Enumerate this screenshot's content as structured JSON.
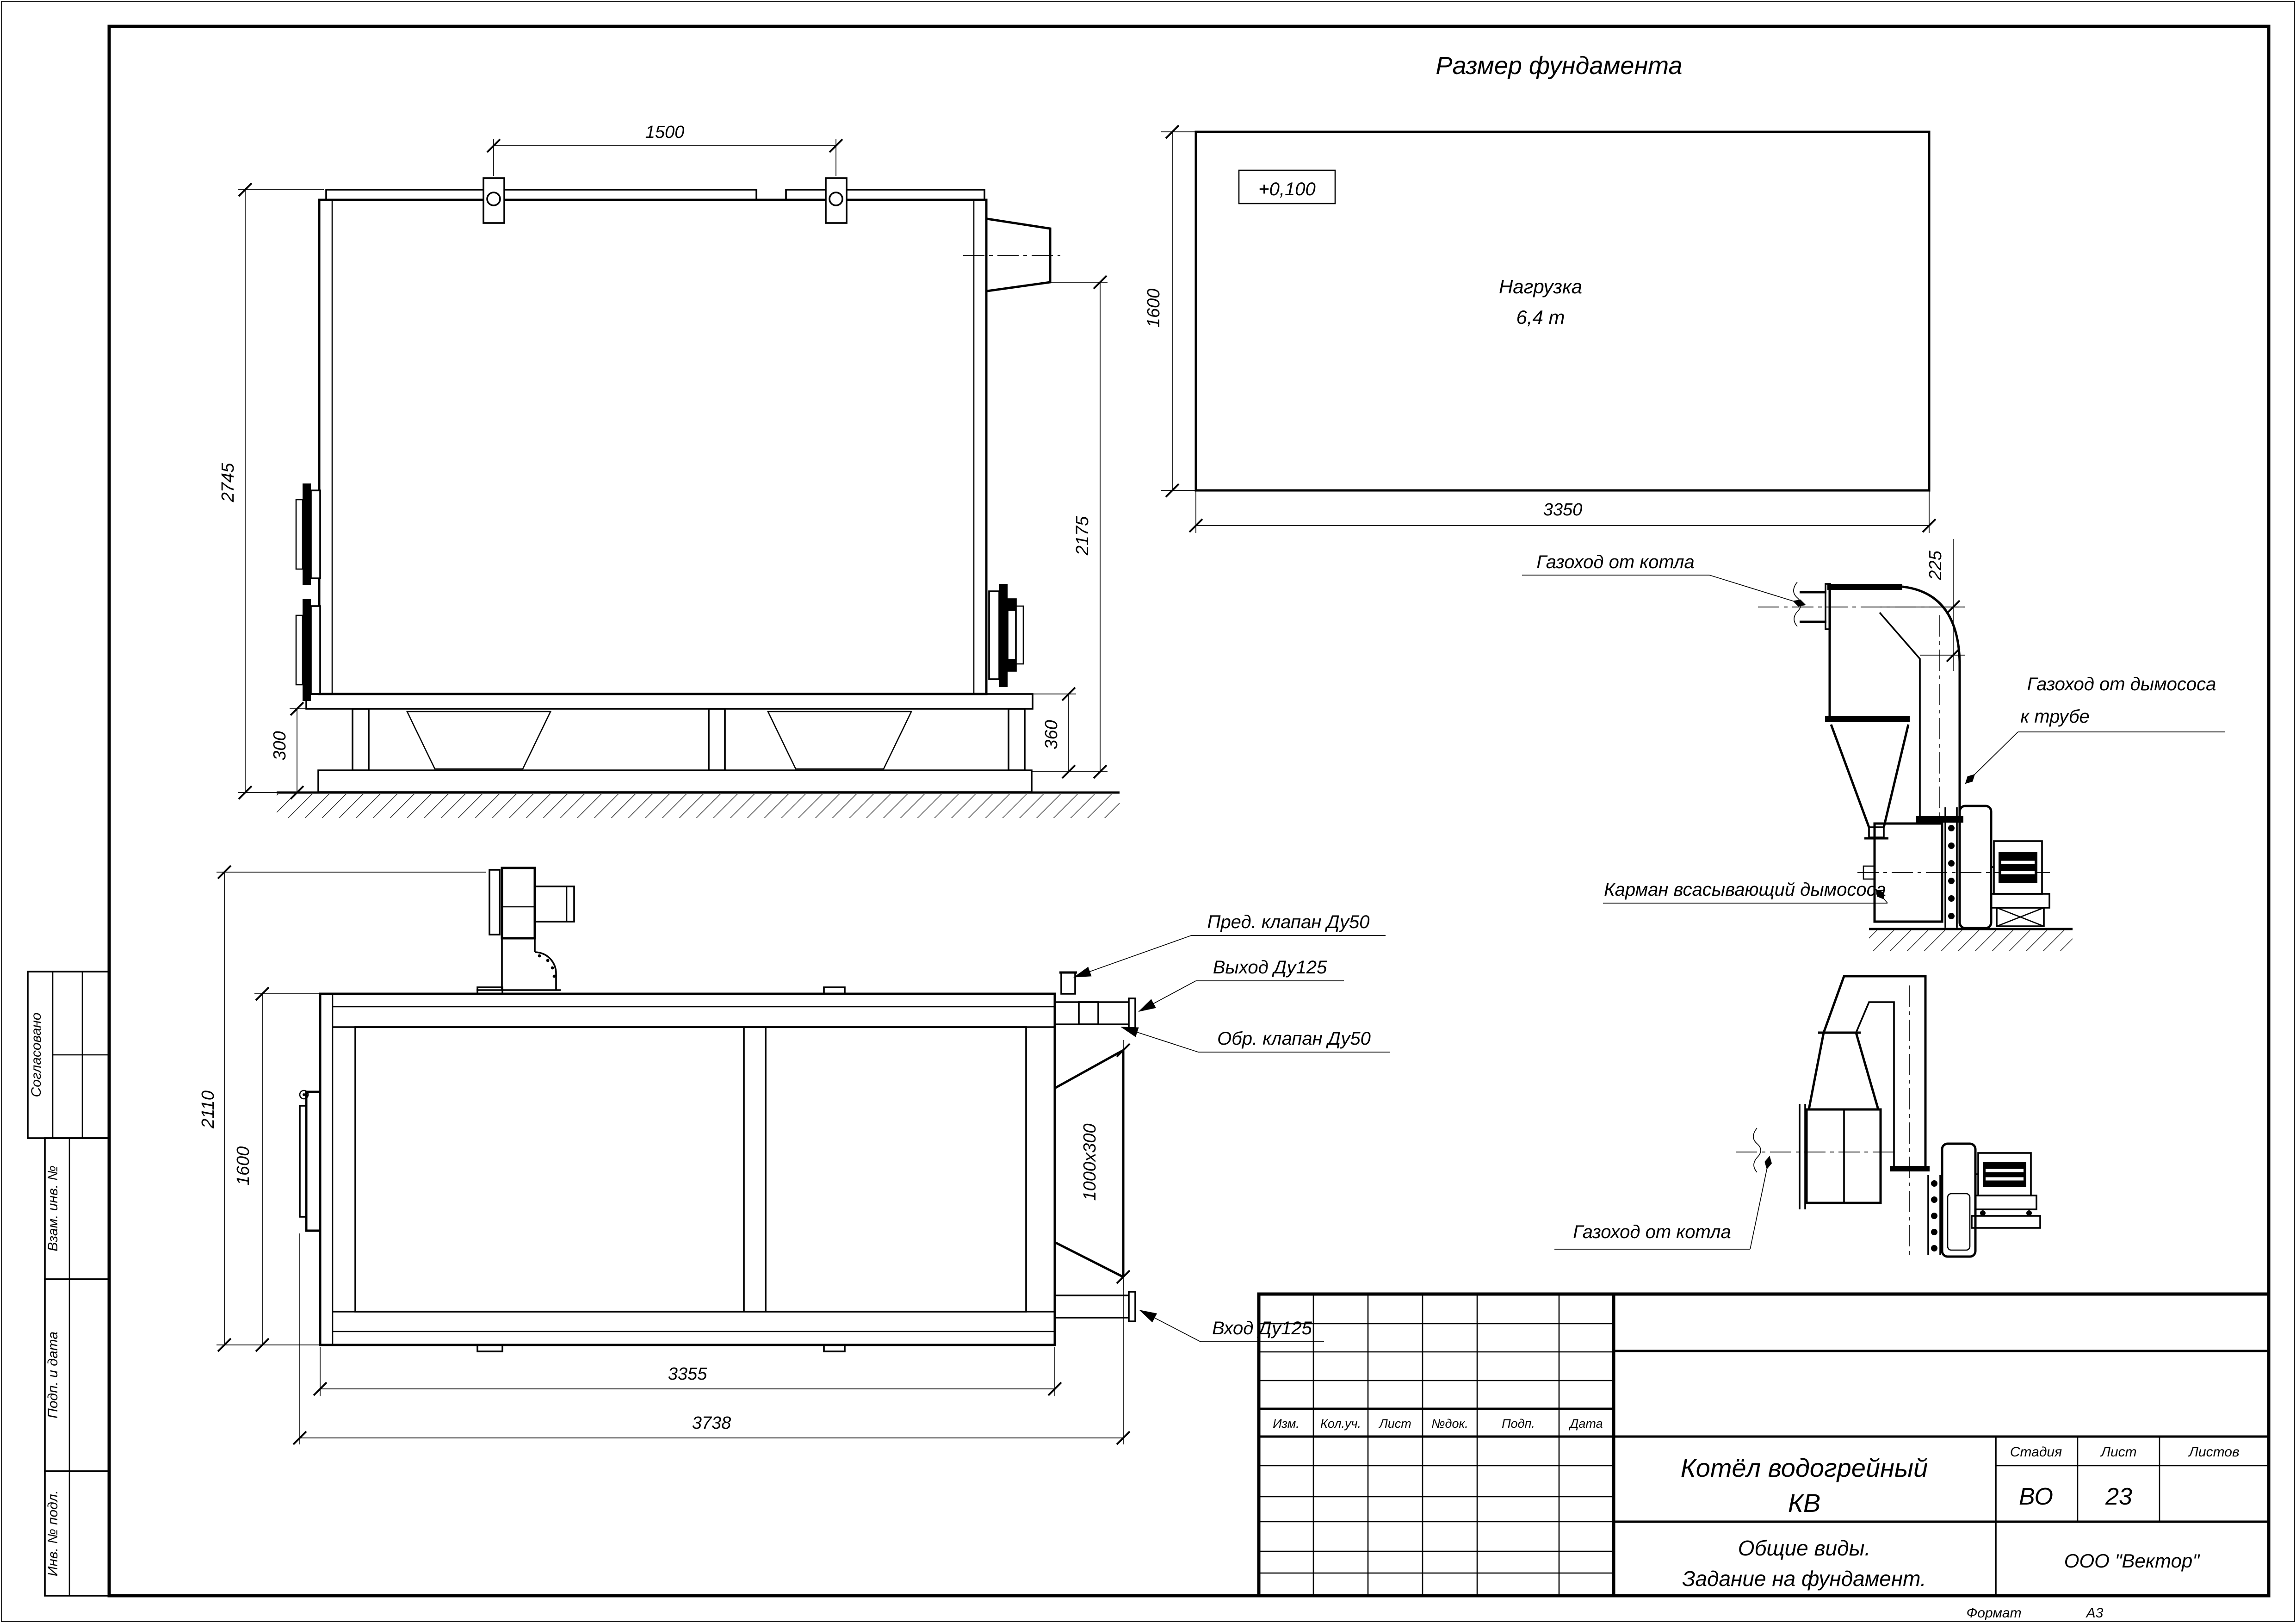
{
  "sheet": {
    "format_label": "Формат",
    "format_value": "А3",
    "stamps": [
      "Согласовано",
      "Взам. инв. №",
      "Подп. и дата",
      "Инв. № подл."
    ]
  },
  "heading": {
    "title": "Размер фундамента"
  },
  "side_view": {
    "dim_top": "1500",
    "dim_left": "2745",
    "dim_bottom_left": "300",
    "dim_right": "2175",
    "dim_bottom_right": "360"
  },
  "foundation_plan": {
    "level_mark": "+0,100",
    "load_line1": "Нагрузка",
    "load_line2": "6,4 т",
    "dim_left": "1600",
    "dim_bottom": "3350"
  },
  "flue_detail_upper": {
    "label_from_boiler": "Газоход от котла",
    "dim_offset": "225",
    "label_to_stack_line1": "Газоход от дымососа",
    "label_to_stack_line2": "к трубе",
    "label_pocket": "Карман всасывающий дымососа"
  },
  "flue_detail_lower": {
    "label_from_boiler": "Газоход от котла"
  },
  "plan_view": {
    "dim_outer_height": "2110",
    "dim_inner_height": "1600",
    "dim_opening": "1000x300",
    "dim_length_inner": "3355",
    "dim_length_outer": "3738",
    "label_safety_valve": "Пред. клапан Ду50",
    "label_outlet": "Выход Ду125",
    "label_check_valve": "Обр. клапан Ду50",
    "label_inlet": "Вход Ду125"
  },
  "title_block": {
    "rev_headers": [
      "Изм.",
      "Кол.уч.",
      "Лист",
      "№док.",
      "Подп.",
      "Дата"
    ],
    "doc_name_line1": "Котёл водогрейный",
    "doc_name_line2": "КВ",
    "stage_header": "Стадия",
    "sheet_header": "Лист",
    "sheets_header": "Листов",
    "stage_value": "ВО",
    "sheet_value": "23",
    "doc_title_line1": "Общие виды.",
    "doc_title_line2": "Задание на фундамент.",
    "company": "ООО \"Вектор\""
  }
}
